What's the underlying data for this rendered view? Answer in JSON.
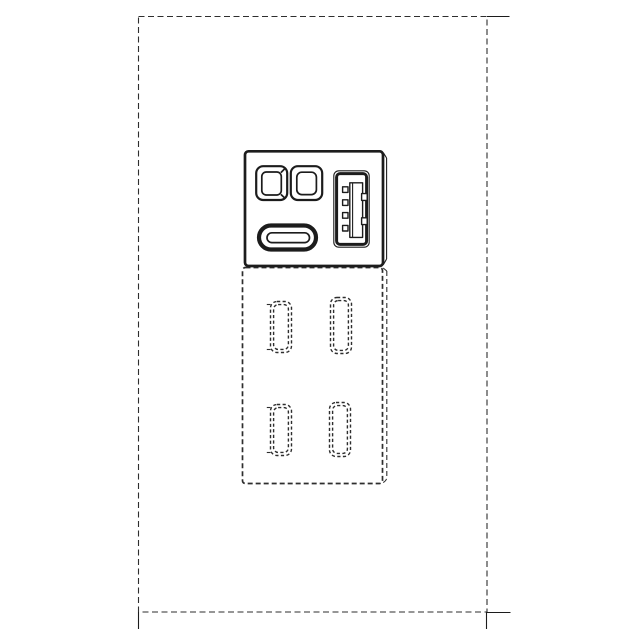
{
  "figure": {
    "background_color": "#ffffff",
    "line_color": "#1c1c1c",
    "hidden_line_color": "#2e2e2e",
    "text": "",
    "components": {
      "wall_plate": "wall-plate-hidden-outline",
      "boundary_lines": "environment-boundary-lines",
      "faceplate": "faceplate-module",
      "opening_left": "rect-opening-left",
      "opening_right": "rect-opening-right",
      "usb_c_port": "usb-c-port",
      "usb_a_port": "usb-a-port",
      "recessed_body": "recessed-body-hidden-outline",
      "rear_connectors": [
        "rear-connector-top-left",
        "rear-connector-top-right",
        "rear-connector-bottom-left",
        "rear-connector-bottom-right"
      ]
    }
  }
}
